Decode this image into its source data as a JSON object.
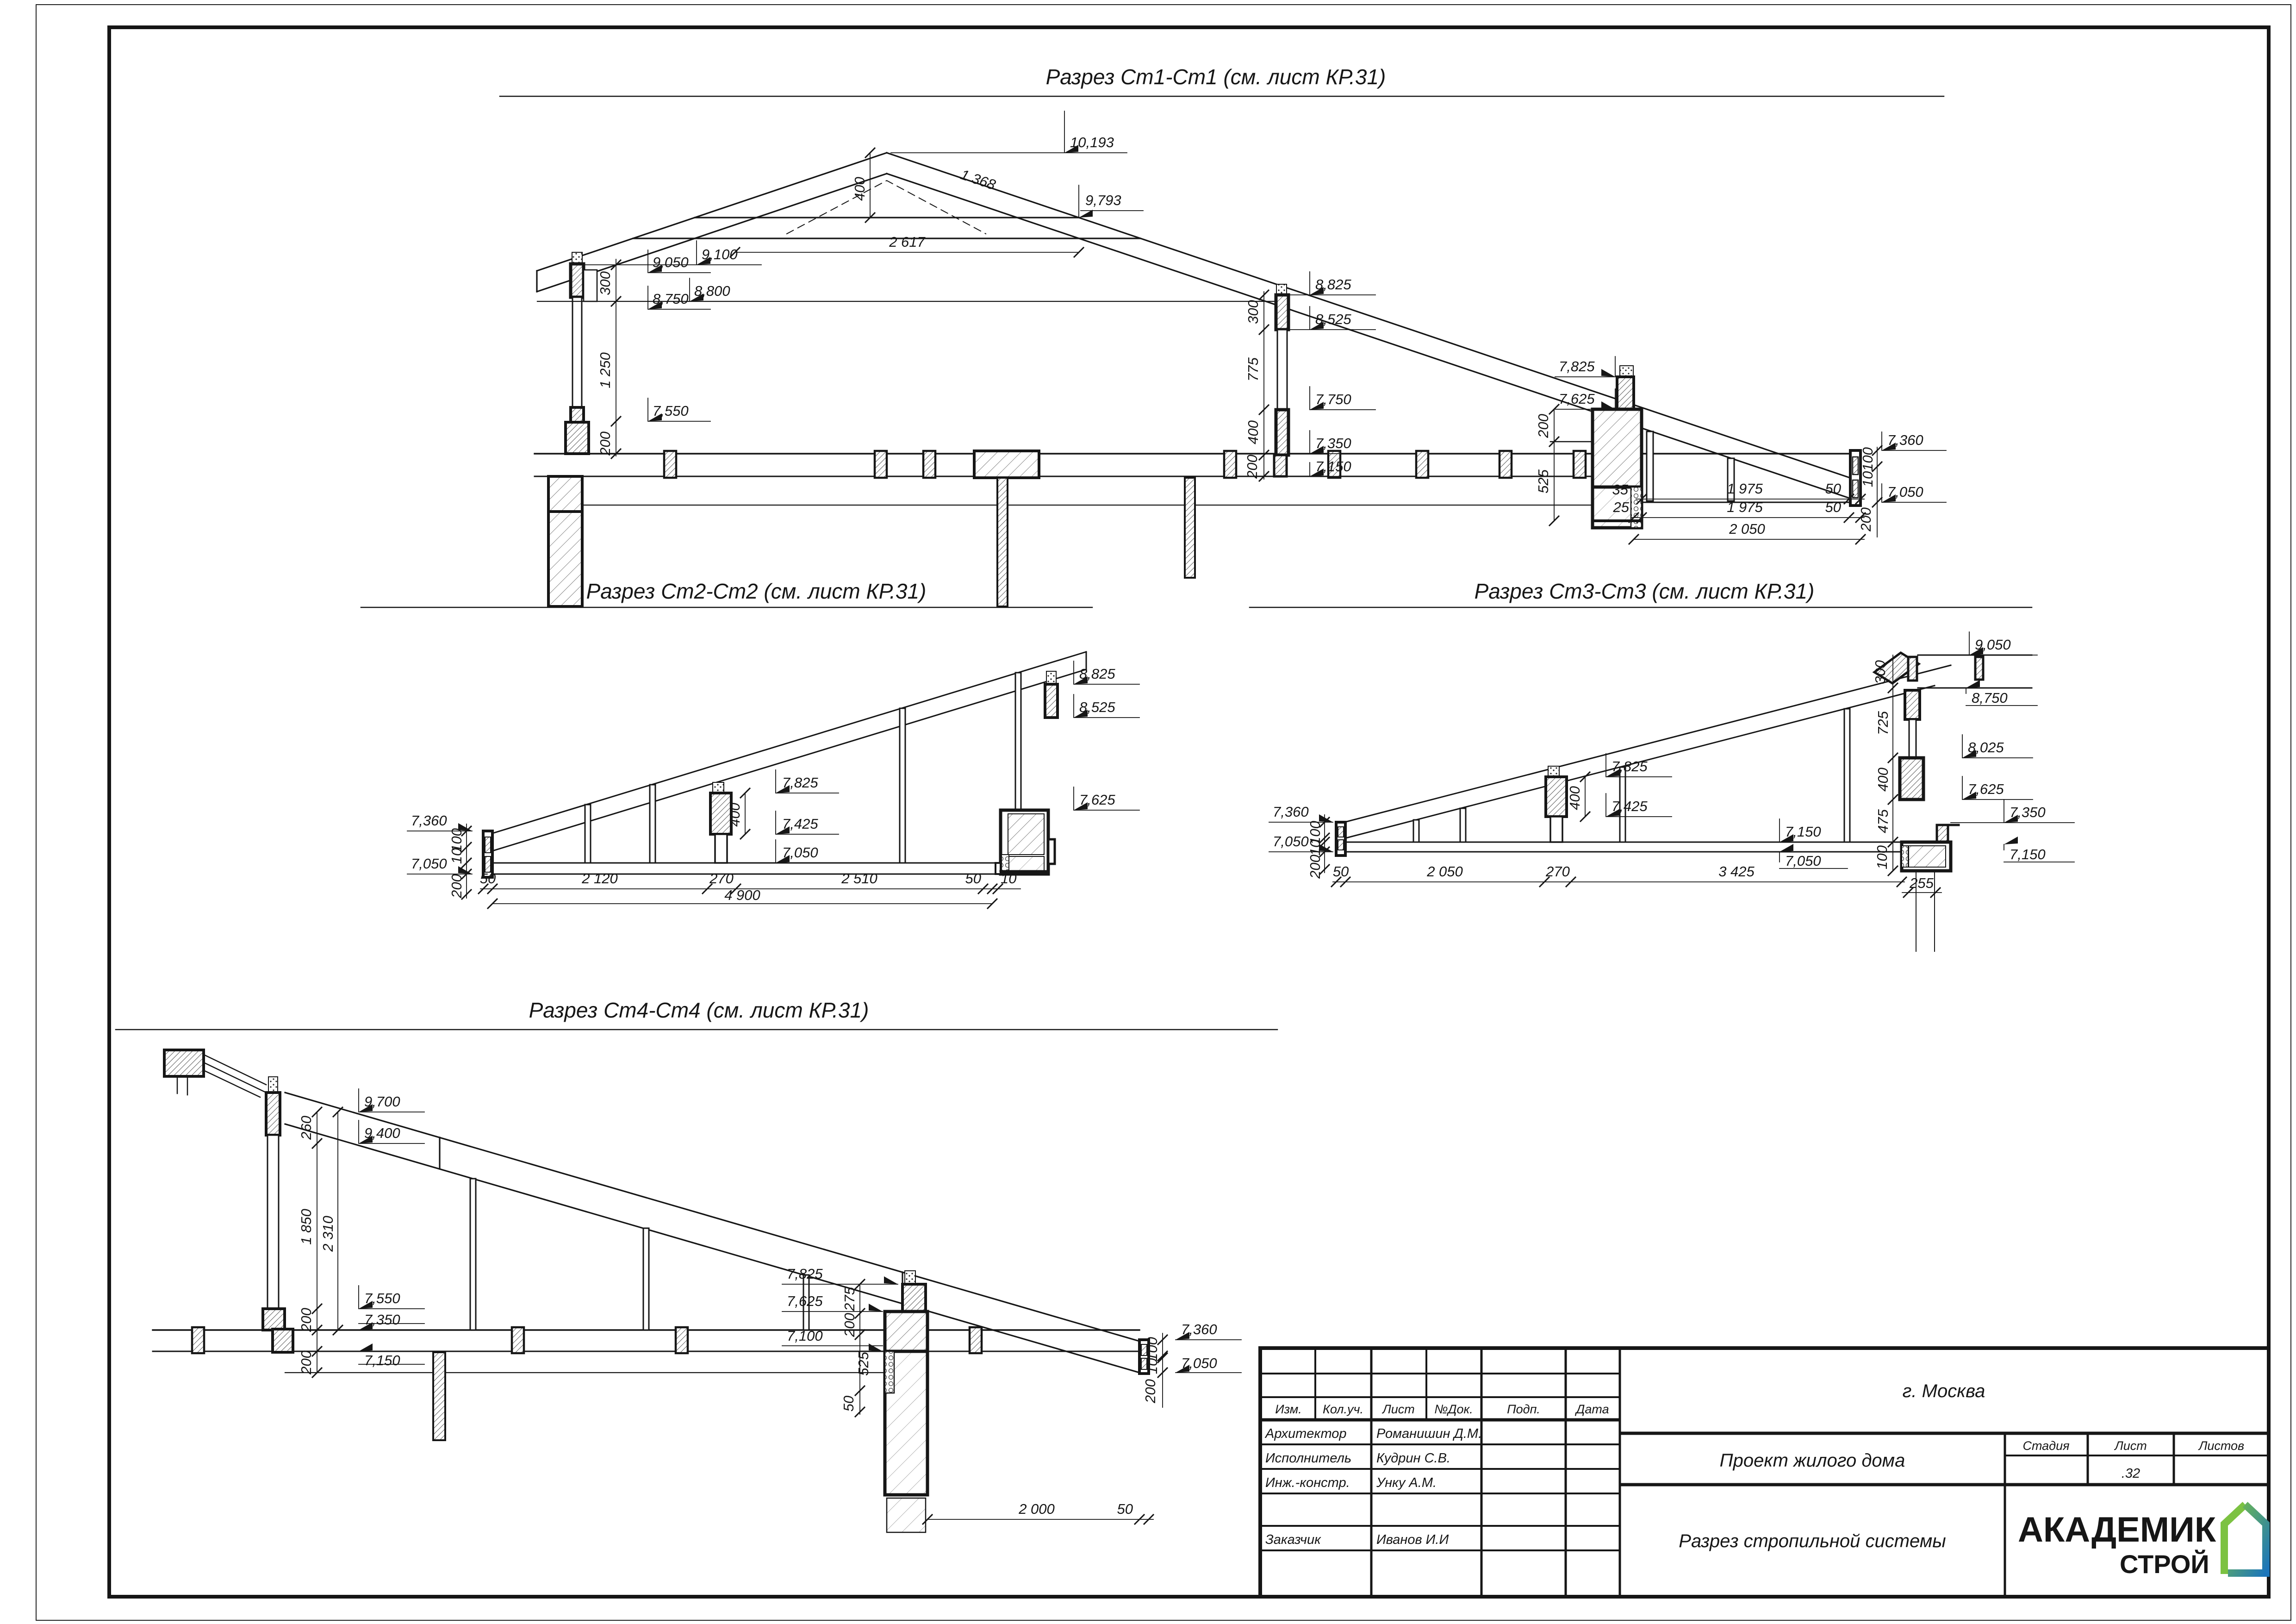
{
  "sheet": {
    "city": "г. Москва",
    "project_title": "Проект жилого дома",
    "drawing_title": "Разрез стропильной системы",
    "stage_label": "Стадия",
    "sheet_label": "Лист",
    "sheets_label": "Листов",
    "sheet_number": ".32",
    "header_cols": {
      "izm": "Изм.",
      "koluch": "Кол.уч.",
      "list": "Лист",
      "ndok": "№Док.",
      "podp": "Подп.",
      "data": "Дата"
    },
    "staff": [
      {
        "role": "Архитектор",
        "name": "Романишин Д.М."
      },
      {
        "role": "Исполнитель",
        "name": "Кудрин С.В."
      },
      {
        "role": "Инж.-констр.",
        "name": "Унку А.М."
      },
      {
        "role": "Заказчик",
        "name": "Иванов И.И"
      }
    ],
    "logo": {
      "line1": "АКАДЕМИК",
      "line2": "СТРОЙ"
    }
  },
  "sections": {
    "st1": {
      "title": "Разрез Ст1-Ст1 (см. лист КР.31)",
      "dims": {
        "e10193": "10,193",
        "s1368": "1 368",
        "e9793": "9,793",
        "v400T": "400",
        "h2617": "2 617",
        "e9100": "9,100",
        "v300L": "300",
        "e9050": "9,050",
        "e8750": "8,750",
        "e8800": "8,800",
        "v1250": "1 250",
        "e7550": "7,550",
        "v200L": "200",
        "e8825": "8,825",
        "v300M": "300",
        "e8525": "8,525",
        "v775": "775",
        "e7750": "7,750",
        "v400M": "400",
        "e7350": "7,350",
        "e7150": "7,150",
        "v200M": "200",
        "e7825": "7,825",
        "e7625": "7,625",
        "v200R": "200",
        "v525": "525",
        "v100": "100",
        "e7360": "7,360",
        "v10": "10",
        "e7050": "7,050",
        "v200F": "200",
        "v35": "35",
        "h1975a": "1 975",
        "h50a": "50",
        "h25": "25",
        "h1975b": "1 975",
        "h50b": "50",
        "h2050": "2 050"
      }
    },
    "st2": {
      "title": "Разрез Ст2-Ст2 (см. лист КР.31)",
      "dims": {
        "e8825": "8,825",
        "e8525": "8,525",
        "e7825": "7,825",
        "v400": "400",
        "e7425": "7,425",
        "e7625": "7,625",
        "e7050m": "7,050",
        "e7360": "7,360",
        "v100": "100",
        "v10": "10",
        "v200": "200",
        "e7050": "7,050",
        "h50a": "50",
        "h2120": "2 120",
        "h270": "270",
        "h2510": "2 510",
        "h50b": "50",
        "h10": "10",
        "h4900": "4 900"
      }
    },
    "st3": {
      "title": "Разрез Ст3-Ст3 (см. лист КР.31)",
      "dims": {
        "e9050": "9,050",
        "v300": "300",
        "e8750": "8,750",
        "v725": "725",
        "e8025": "8,025",
        "v400R": "400",
        "e7625R": "7,625",
        "v475": "475",
        "e7350R": "7,350",
        "e7150R": "7,150",
        "v100R": "100",
        "h255": "255",
        "e7825": "7,825",
        "v400M": "400",
        "e7425": "7,425",
        "e7150m": "7,150",
        "e7050m": "7,050",
        "e7360": "7,360",
        "v100L": "100",
        "v10": "10",
        "v200": "200",
        "e7050": "7,050",
        "h50": "50",
        "h2050": "2 050",
        "h270": "270",
        "h3425": "3 425"
      }
    },
    "st4": {
      "title": "Разрез Ст4-Ст4 (см. лист КР.31)",
      "dims": {
        "e9700": "9,700",
        "v260": "260",
        "e9400": "9,400",
        "v1850": "1 850",
        "v2310": "2 310",
        "e7550": "7,550",
        "v200a": "200",
        "e7350": "7,350",
        "v200b": "200",
        "e7150": "7,150",
        "e7825": "7,825",
        "v275": "275",
        "e7625": "7,625",
        "v200c": "200",
        "v525": "525",
        "e7100": "7,100",
        "v50": "50",
        "v100": "100",
        "e7360": "7,360",
        "v10": "10",
        "e7050": "7,050",
        "v200d": "200",
        "h2000": "2 000",
        "h50": "50"
      }
    }
  }
}
